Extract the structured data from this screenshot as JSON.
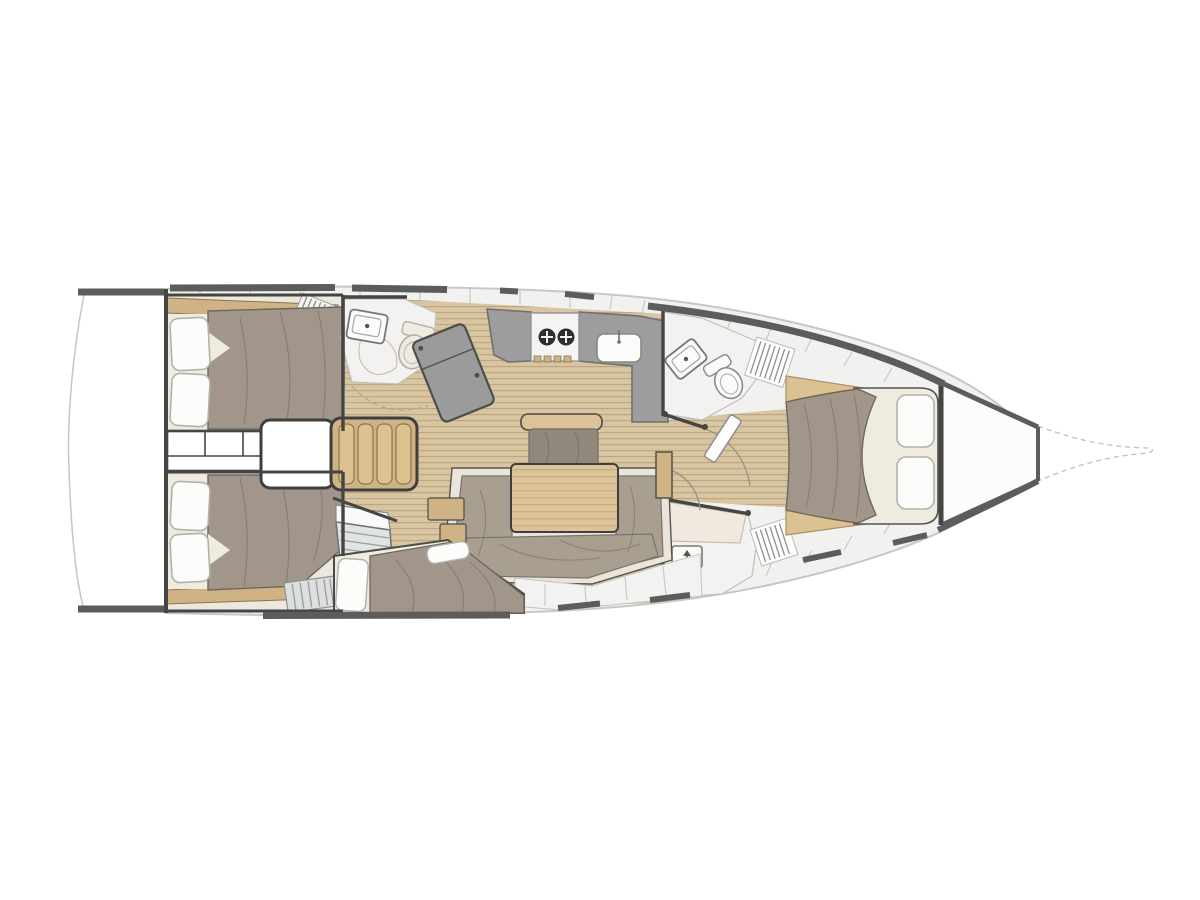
{
  "diagram": {
    "type": "sailboat-interior-floor-plan",
    "orientation": "bow-right",
    "rooms": [
      "swim-platform",
      "aft-cabin-port",
      "aft-cabin-starboard",
      "engine-compartment",
      "companionway-stairs",
      "aft-head",
      "nav-station",
      "galley",
      "salon",
      "mid-cabin",
      "forward-head",
      "day-head",
      "forward-cabin",
      "anchor-locker",
      "bowsprit"
    ]
  },
  "colors": {
    "page-bg": "#ffffff",
    "hull-band": "#f1f2f0",
    "hull-rim": "#c7c8c6",
    "dark-line": "#454543",
    "perimeter": "#5c5d5b",
    "plank-base": "#d8c5a1",
    "plank-line": "#bda57c",
    "cabin-floor": "#ece8dd",
    "mattress": "#f0ebdf",
    "pillow": "#fcfcfb",
    "pillow-edge": "#b2b2ad",
    "duvet": "#a2968a",
    "duvet-edge": "#6e675f",
    "wood": "#cfb384",
    "wood-light": "#ddc291",
    "wood-edge": "#8a7450",
    "table": "#dcc498",
    "cushion": "#a99f90",
    "cushion-dark": "#8e897b",
    "cushion-edge": "#7a7468",
    "counter": "#9c9d9c",
    "counter-edge": "#6f6f6f",
    "fixture-white": "#fbfbfa",
    "fixture-edge": "#8a8a8a",
    "room-floor": "#f3f2f0",
    "room-edge": "#c0c0bb",
    "cream-border": "#e9e5da",
    "seam": "#c9c9c5",
    "wardrobe": "#e0e4e3",
    "wardrobe-line": "#989e9c",
    "burner": "#2e2e2e"
  }
}
